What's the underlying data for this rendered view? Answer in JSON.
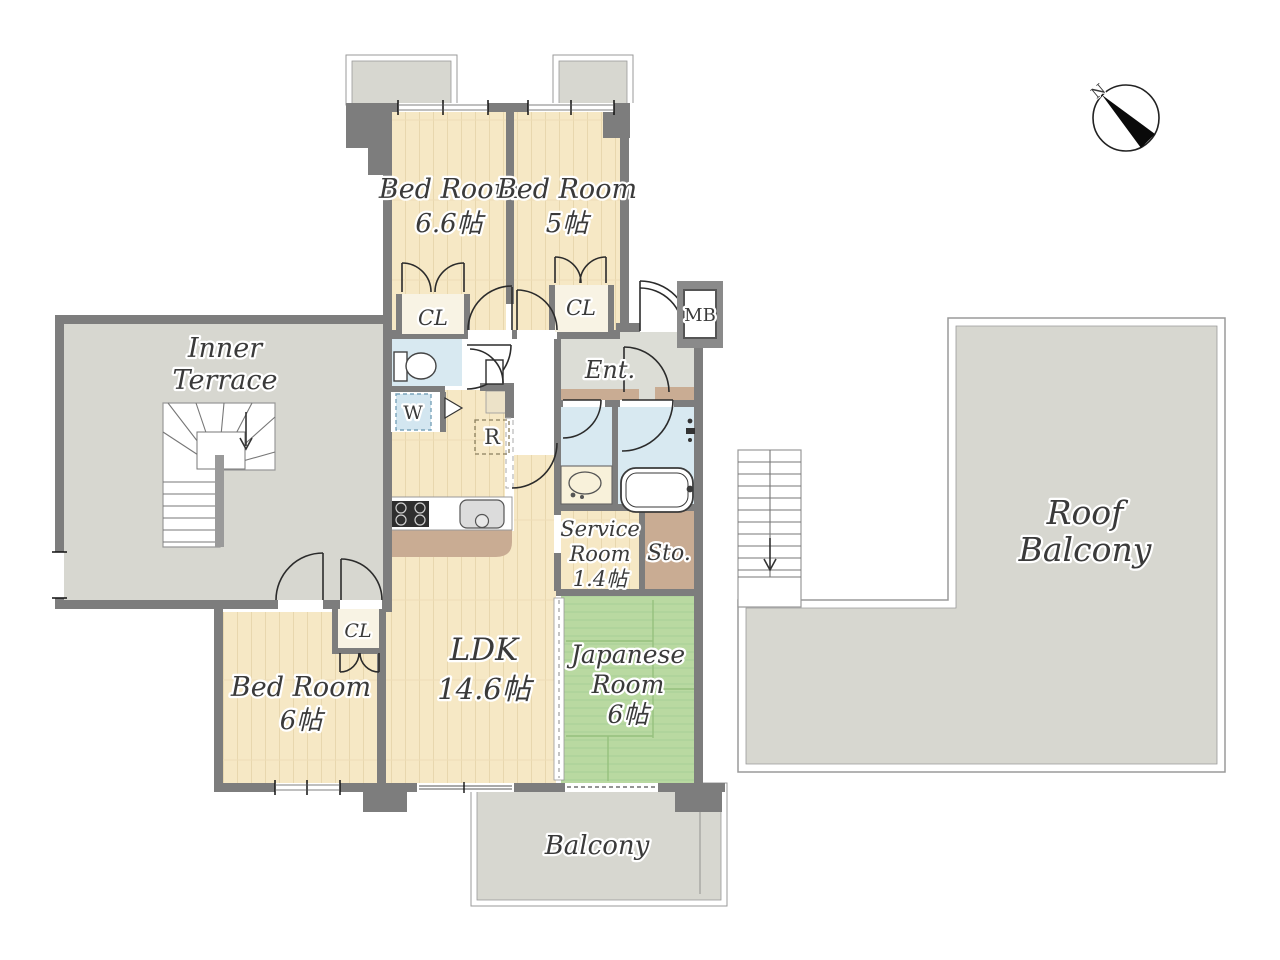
{
  "plan": {
    "compass": {
      "north_label": "N"
    },
    "rooms": {
      "bedroom1": {
        "name": "Bed Room",
        "size": "6.6帖"
      },
      "bedroom2": {
        "name": "Bed Room",
        "size": "5帖"
      },
      "bedroom3": {
        "name": "Bed Room",
        "size": "6帖"
      },
      "ldk": {
        "name": "LDK",
        "size": "14.6帖"
      },
      "japanese_room": {
        "name_line1": "Japanese",
        "name_line2": "Room",
        "size": "6帖"
      },
      "service_room": {
        "name_line1": "Service",
        "name_line2": "Room",
        "size": "1.4帖"
      },
      "storage": {
        "label": "Sto."
      },
      "entrance": {
        "label": "Ent."
      },
      "inner_terrace": {
        "name_line1": "Inner",
        "name_line2": "Terrace"
      },
      "roof_balcony": {
        "name_line1": "Roof",
        "name_line2": "Balcony"
      },
      "balcony": {
        "label": "Balcony"
      }
    },
    "fixtures": {
      "closet1": "CL",
      "closet2": "CL",
      "closet3": "CL",
      "meter_box": "MB",
      "washer": "W",
      "refrigerator": "R"
    },
    "colors": {
      "wall": "#7d7d7d",
      "wood_floor": "#f6e8c5",
      "tatami_green": "#b9d9a1",
      "wet_area_blue": "#d8e9f1",
      "terrace_gray": "#d7d7d0",
      "kitchen_accent_tan": "#c9ac93",
      "label_text": "#3a3a3a"
    }
  }
}
